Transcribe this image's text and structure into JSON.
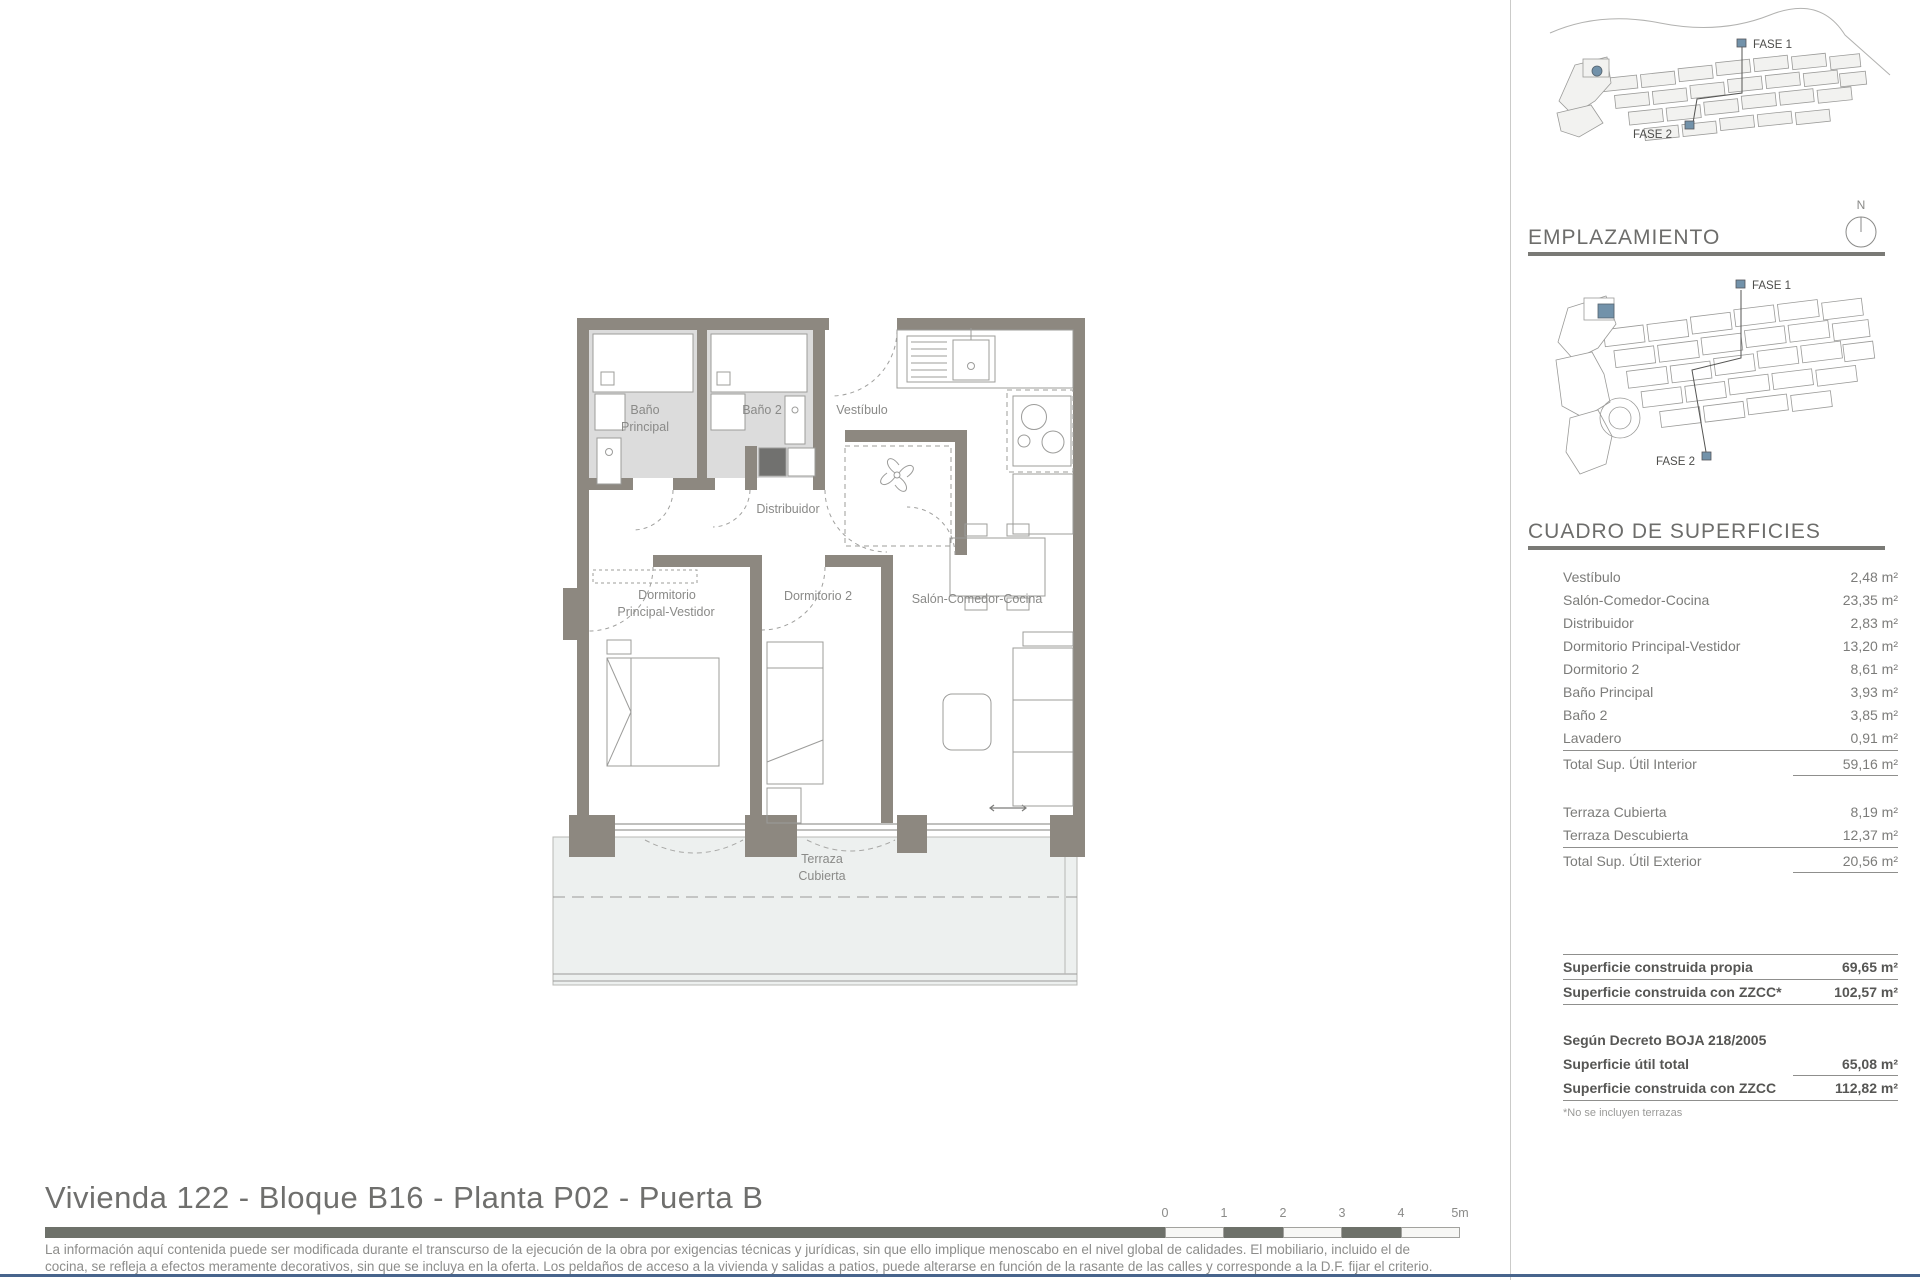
{
  "page": {
    "title": "Vivienda 122 - Bloque B16 - Planta P02 - Puerta B",
    "disclaimer_line1": "La información aquí contenida puede  ser modificada durante el transcurso de la ejecución de la obra por exigencias técnicas y jurídicas,  sin  que  ello  implique  menoscabo  en el nivel global de calidades.  El  mobiliario, incluido el de",
    "disclaimer_line2": "cocina, se refleja a efectos meramente decorativos, sin que se incluya en la oferta. Los peldaños de acceso a la vivienda y  salidas  a patios,  puede alterarse  en función de la rasante de las calles y corresponde a  la  D.F.  fijar el criterio."
  },
  "plan": {
    "rooms": {
      "bano_principal_1": "Baño",
      "bano_principal_2": "Principal",
      "bano2": "Baño 2",
      "vestibulo": "Vestíbulo",
      "distribuidor": "Distribuidor",
      "dormitorio_principal_1": "Dormitorio",
      "dormitorio_principal_2": "Principal-Vestidor",
      "dormitorio2": "Dormitorio 2",
      "salon": "Salón-Comedor-Cocina",
      "terraza_1": "Terraza",
      "terraza_2": "Cubierta"
    }
  },
  "siteplans": {
    "fase1": "FASE 1",
    "fase2": "FASE 2",
    "north": "N",
    "emplazamiento_heading": "EMPLAZAMIENTO"
  },
  "surfaces": {
    "heading": "CUADRO DE SUPERFICIES",
    "interior": [
      {
        "label": "Vestíbulo",
        "value": "2,48 m²"
      },
      {
        "label": "Salón-Comedor-Cocina",
        "value": "23,35 m²"
      },
      {
        "label": "Distribuidor",
        "value": "2,83 m²"
      },
      {
        "label": "Dormitorio Principal-Vestidor",
        "value": "13,20 m²"
      },
      {
        "label": "Dormitorio 2",
        "value": "8,61 m²"
      },
      {
        "label": "Baño Principal",
        "value": "3,93 m²"
      },
      {
        "label": "Baño 2",
        "value": "3,85 m²"
      },
      {
        "label": "Lavadero",
        "value": "0,91 m²"
      }
    ],
    "interior_total": {
      "label": "Total Sup. Útil Interior",
      "value": "59,16 m²"
    },
    "exterior": [
      {
        "label": "Terraza Cubierta",
        "value": "8,19 m²"
      },
      {
        "label": "Terraza Descubierta",
        "value": "12,37 m²"
      }
    ],
    "exterior_total": {
      "label": "Total Sup. Útil Exterior",
      "value": "20,56 m²"
    },
    "built": [
      {
        "label": "Superficie construida propia",
        "value": "69,65 m²"
      },
      {
        "label": "Superficie construida con ZZCC*",
        "value": "102,57 m²"
      }
    ],
    "decree_heading": "Según Decreto BOJA 218/2005",
    "decree": [
      {
        "label": "Superficie útil total",
        "value": "65,08 m²"
      },
      {
        "label": "Superficie construida con ZZCC",
        "value": "112,82 m²"
      }
    ],
    "footnote": "*No se incluyen terrazas"
  },
  "scale_bar": {
    "labels": [
      "0",
      "1",
      "2",
      "3",
      "4",
      "5m"
    ]
  },
  "colors": {
    "wall": "#8d8880",
    "bath_floor": "#dcdcdc",
    "terrace_fill": "#edf0ef",
    "accent_blue": "#7292aa",
    "rule_gray": "#6e716a",
    "navy_rule": "#47648c"
  }
}
